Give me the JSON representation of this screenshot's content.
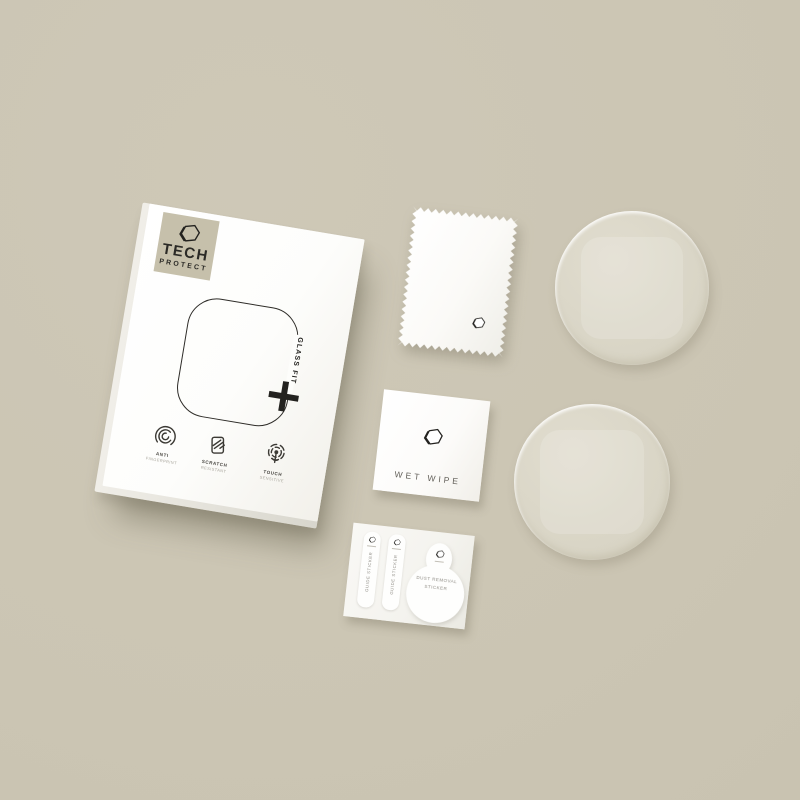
{
  "scene": {
    "description": "Flat-lay product photo of a TECH PROTECT GLASS FIT round watch screen protector kit on a warm beige background",
    "background_color": "#cbc5b3",
    "ink_color": "#23221f",
    "disc_color": "#dad6c7"
  },
  "box": {
    "logo_square_color": "#c6c0ab",
    "brand": {
      "line1": "TECH",
      "line2": "PROTECT"
    },
    "product_label_vertical": "GLASS FIT",
    "plus_symbol": "+",
    "features": [
      {
        "icon": "fingerprint-icon",
        "title": "ANTI",
        "subtitle": "FINGERPRINT"
      },
      {
        "icon": "scratch-resistant-icon",
        "title": "SCRATCH",
        "subtitle": "RESISTANT"
      },
      {
        "icon": "touch-sensitive-icon",
        "title": "TOUCH",
        "subtitle": "SENSITIVE"
      }
    ]
  },
  "cleaning_cloth": {
    "description": "white microfiber cloth with zigzag pinked edges and hexagon logo"
  },
  "wet_wipe": {
    "label": "WET WIPE"
  },
  "glass_discs": [
    {
      "description": "round tempered glass protector"
    },
    {
      "description": "round tempered glass protector"
    }
  ],
  "sticker_sheet": {
    "guide_strips": [
      {
        "label": "GUIDE STICKER"
      },
      {
        "label": "GUIDE STICKER"
      }
    ],
    "dust_removal_sticker": {
      "line1": "DUST REMOVAL",
      "line2": "STICKER"
    }
  }
}
